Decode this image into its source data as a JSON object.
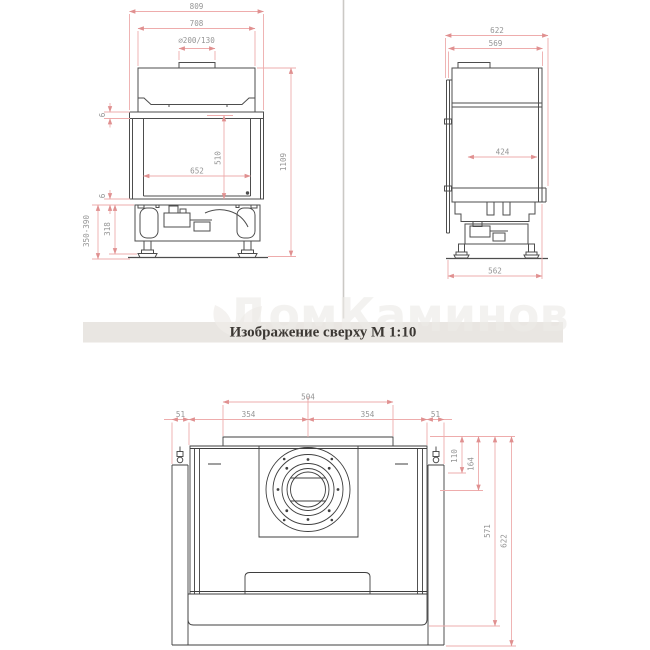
{
  "title_bar": {
    "label": "Изображение сверху М 1:10"
  },
  "watermark": {
    "text": "ДомКаминов"
  },
  "front_view": {
    "dims": {
      "overall_width": "809",
      "hood_width": "708",
      "flue_diameter": "⌀200/130",
      "opening_width": "652",
      "opening_height": "510",
      "total_height": "1109",
      "gap_top": "6",
      "gap_bottom": "6",
      "plinth_height_range": "350-390",
      "plinth_height": "318"
    }
  },
  "side_view": {
    "dims": {
      "overall_depth": "622",
      "body_depth": "569",
      "inner_depth": "424",
      "base_depth": "562"
    }
  },
  "top_view": {
    "dims": {
      "top_plate_width": "504",
      "width_segments": [
        "51",
        "354",
        "354",
        "51"
      ],
      "collar_rear_offset": "110",
      "collar_center_offset": "164",
      "frame_depth": "571",
      "overall_depth": "622"
    }
  },
  "colors": {
    "dimension_line": "#eeacac",
    "dimension_text": "#949494",
    "drawing_line": "#4d4d4d",
    "title_bar_bg": "#e9e6e2",
    "title_text": "#3c3834",
    "divider": "#cbc9c5"
  }
}
